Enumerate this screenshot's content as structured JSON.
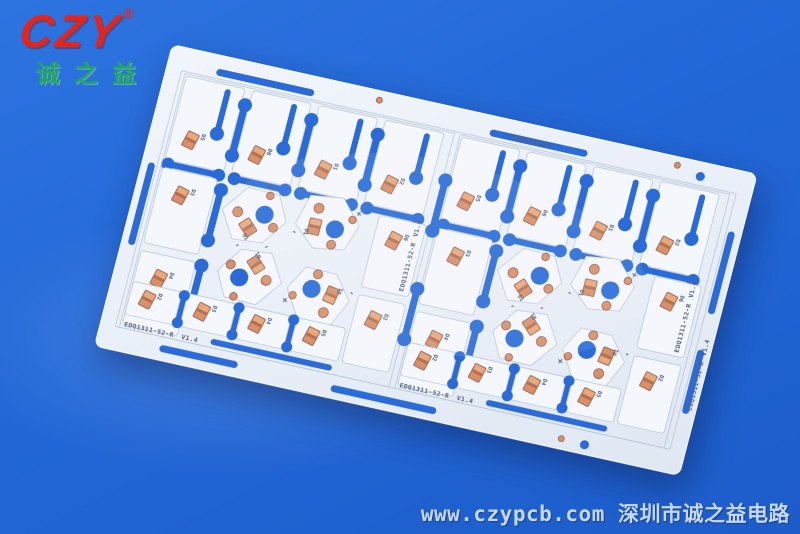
{
  "scene": {
    "description": "Product photo of a white aluminum LED PCB panel lying on a blue backdrop",
    "background_color": "#2267d7"
  },
  "brand": {
    "logo_text": "CZY",
    "registered_mark": "®",
    "logo_subtext": "诚之益",
    "logo_color": "#e3251b",
    "subtext_color": "#1fa55c"
  },
  "pcb": {
    "part_number": "EDQ1311-52-R",
    "version": "V1.4",
    "serial": "+46417661",
    "designators": [
      "D1",
      "D2",
      "D3",
      "D4",
      "D5",
      "D6"
    ],
    "polarity_plus": "+",
    "polarity_minus": "-",
    "colors": {
      "panel_white": "#edf2f9",
      "sub_board_white": "#f4f7fc",
      "routed_slot_blue": "#2a6bd8",
      "copper_pad": "#d8906a",
      "silkscreen": "#53627f"
    }
  },
  "footer": {
    "url": "www.czypcb.com",
    "company": "深圳市诚之益电路",
    "text_color": "#c6d8f3"
  }
}
